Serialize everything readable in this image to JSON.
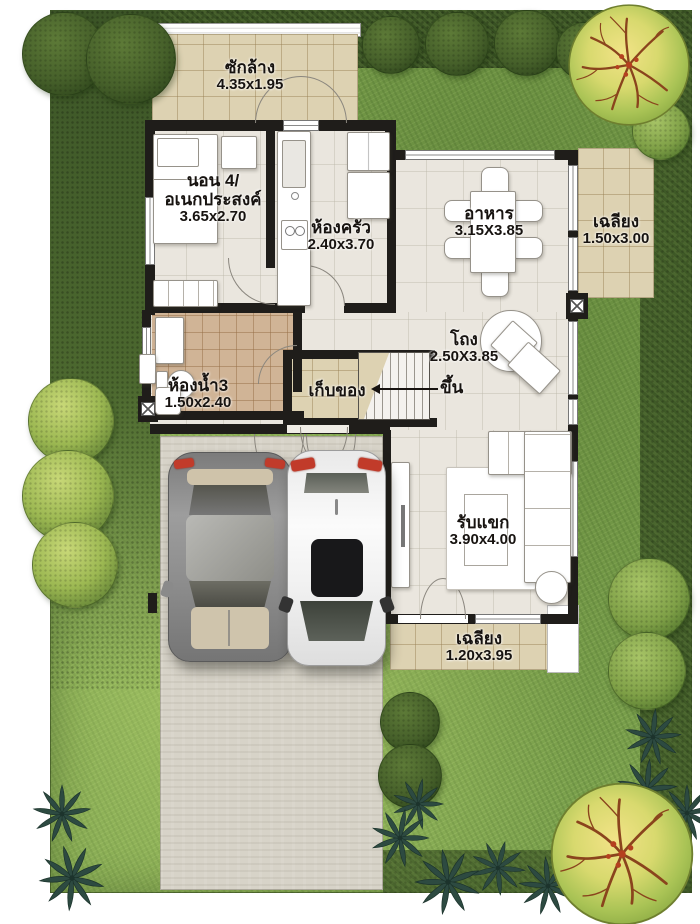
{
  "plan": {
    "type": "floor-plan",
    "rooms": {
      "laundry": {
        "name": "ซักล้าง",
        "dim": "4.35x1.95"
      },
      "bedroom4": {
        "name_line1": "นอน 4/",
        "name_line2": "อเนกประสงค์",
        "dim": "3.65x2.70"
      },
      "kitchen": {
        "name": "ห้องครัว",
        "dim": "2.40x3.70"
      },
      "dining": {
        "name": "อาหาร",
        "dim": "3.15X3.85"
      },
      "porch_right": {
        "name": "เฉลียง",
        "dim": "1.50x3.00"
      },
      "hall": {
        "name": "โถง",
        "dim": "2.50X3.85"
      },
      "bathroom3": {
        "name": "ห้องน้ำ3",
        "dim": "1.50x2.40"
      },
      "storage": {
        "name": "เก็บของ"
      },
      "stairs": {
        "up_label": "ขึ้น"
      },
      "living": {
        "name": "รับแขก",
        "dim": "3.90x4.00"
      },
      "porch_bottom": {
        "name": "เฉลียง",
        "dim": "1.20x3.95"
      },
      "carpark": {
        "name": "จอดรถ"
      }
    },
    "colors": {
      "grass": "#7aa04c",
      "hedge": "#46602c",
      "floor": "#eae6de",
      "porch_tile": "#ddd2b2",
      "bath_tile": "#d0b496",
      "wall": "#1f1d1a",
      "concrete": "#d7d3c8",
      "taillight": "#c13b2a",
      "tree_yellow": "#e8d96e",
      "tree_green": "#7fa047",
      "palm": "#2d4a41"
    }
  }
}
